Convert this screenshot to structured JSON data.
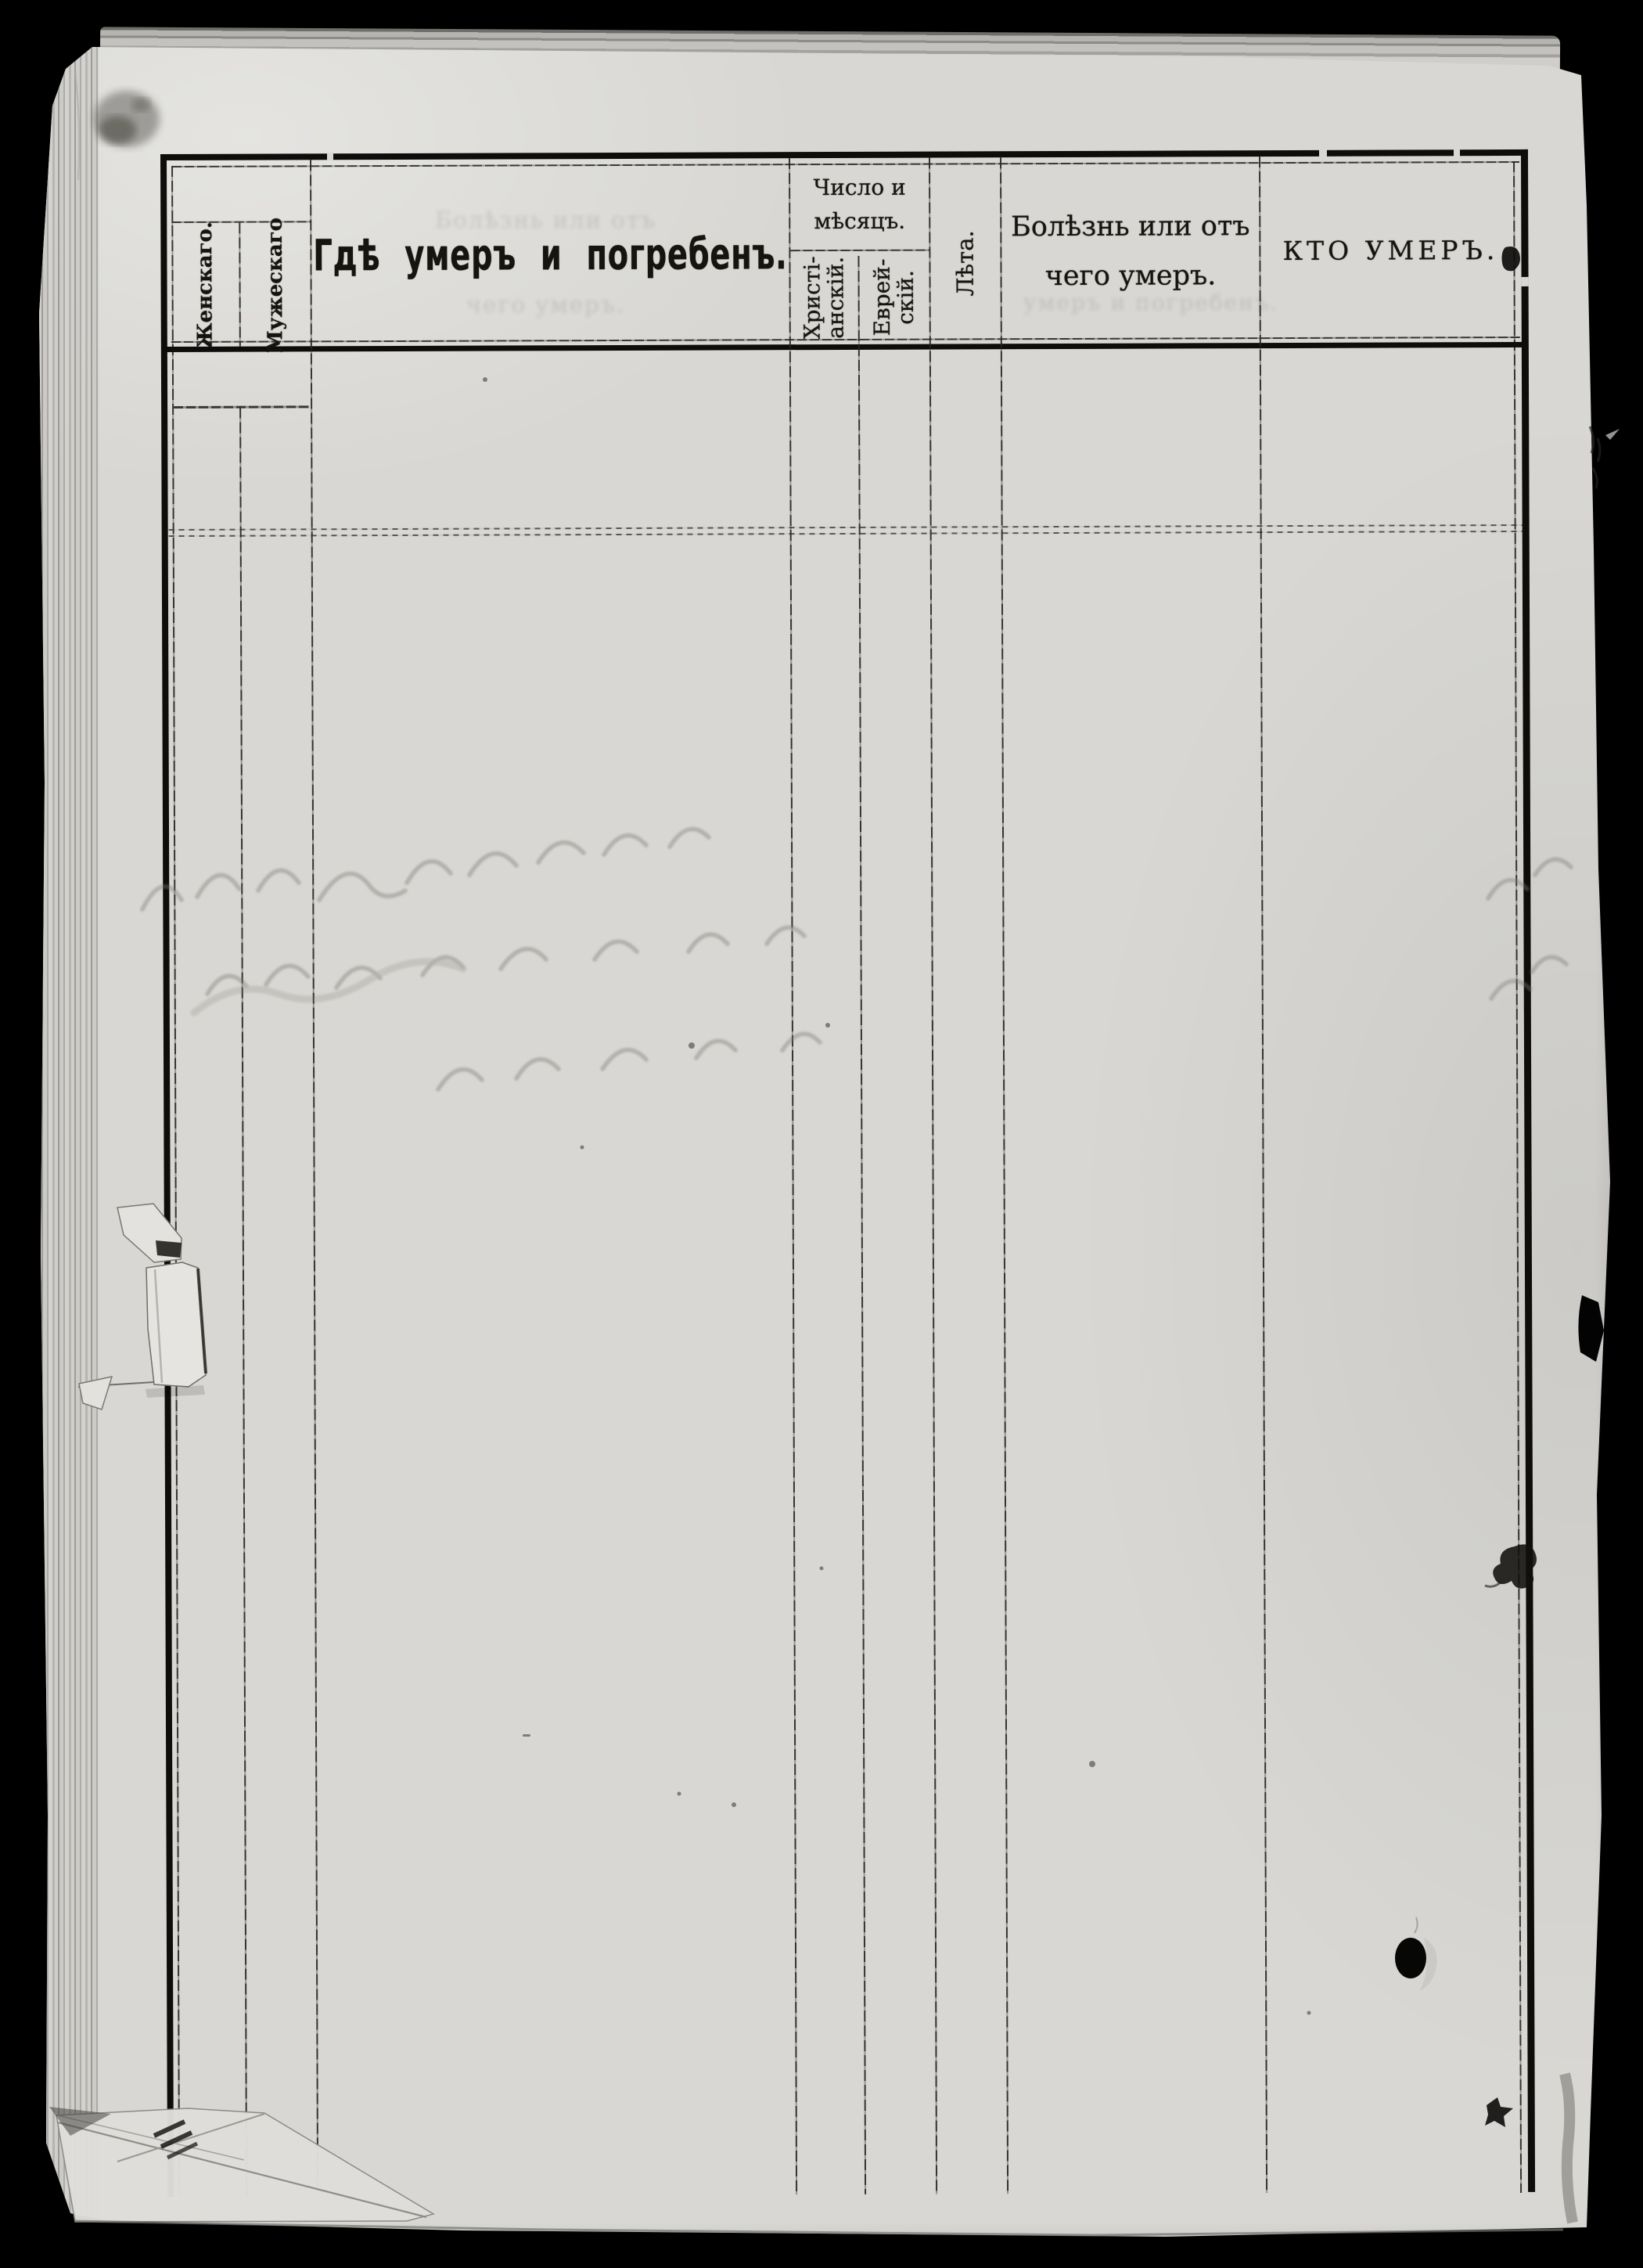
{
  "table": {
    "headers": {
      "female": "Женскаго.",
      "male": "Мужескаго",
      "where_died": "Гдѣ умеръ и погребенъ.",
      "date_group_line1": "Число и",
      "date_group_line2": "мѣсяцъ.",
      "christian_line1": "Христі-",
      "christian_line2": "анскій.",
      "jewish_line1": "Еврей-",
      "jewish_line2": "скій.",
      "age": "Лѣта.",
      "cause_line1": "Болѣзнь или отъ",
      "cause_line2": "чего умеръ.",
      "who_died": "КТО УМЕРЪ."
    },
    "rows": []
  },
  "bleedthrough": {
    "under_where_line1": "Болѣзнь или отъ",
    "under_where_line2": "чего умеръ.",
    "under_cause": "умеръ и погребенъ."
  },
  "colors": {
    "background": "#000000",
    "paper": "#d8d7d3",
    "paper_light": "#e8e7e3",
    "ink": "#14130f",
    "rule_thin": "#2c2b28"
  }
}
